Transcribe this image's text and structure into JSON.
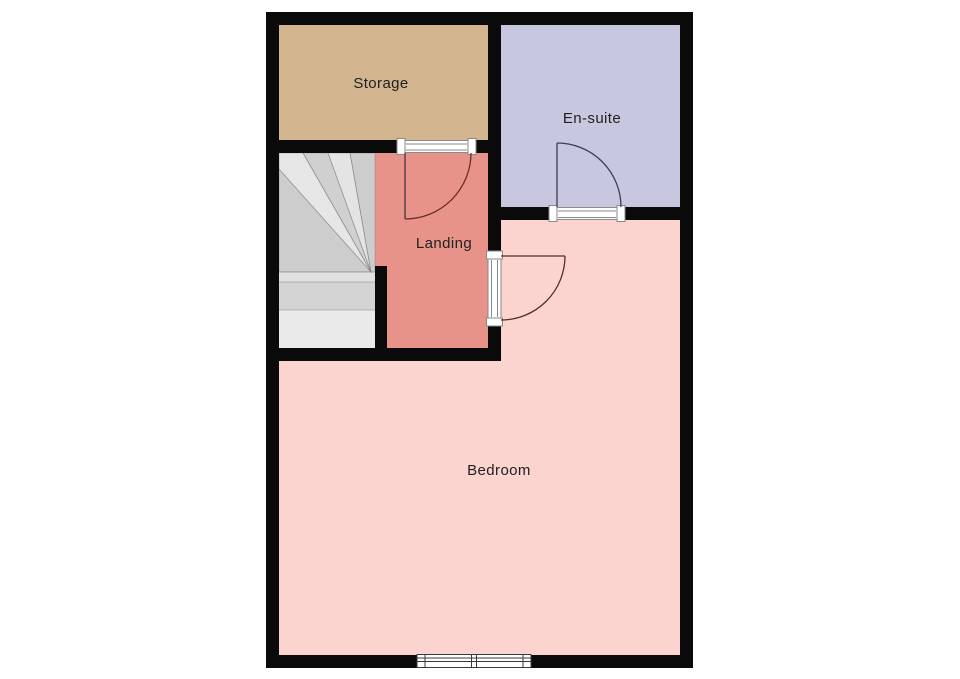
{
  "floorplan": {
    "background": "#ffffff",
    "wall_color": "#0a0a0a",
    "label_color": "#212121",
    "rooms": {
      "storage": {
        "label": "Storage",
        "color": "#d2b48f"
      },
      "ensuite": {
        "label": "En-suite",
        "color": "#c7c7df"
      },
      "landing": {
        "label": "Landing",
        "color": "#e8938a"
      },
      "bedroom": {
        "label": "Bedroom",
        "color": "#fbd4d0"
      }
    },
    "stairs": {
      "base_color": "#d9d9d9"
    },
    "doors": {
      "storage": {
        "leaf_color": "#3c3c3c",
        "arc_color": "#6b2d2d"
      },
      "ensuite": {
        "leaf_color": "#3d3d57",
        "arc_color": "#3d3d57"
      },
      "bedroom": {
        "leaf_color": "#5d2727",
        "arc_color": "#5d2727"
      }
    },
    "door_frame_color": "#ffffff",
    "window": {
      "frame_color": "#ffffff"
    }
  }
}
